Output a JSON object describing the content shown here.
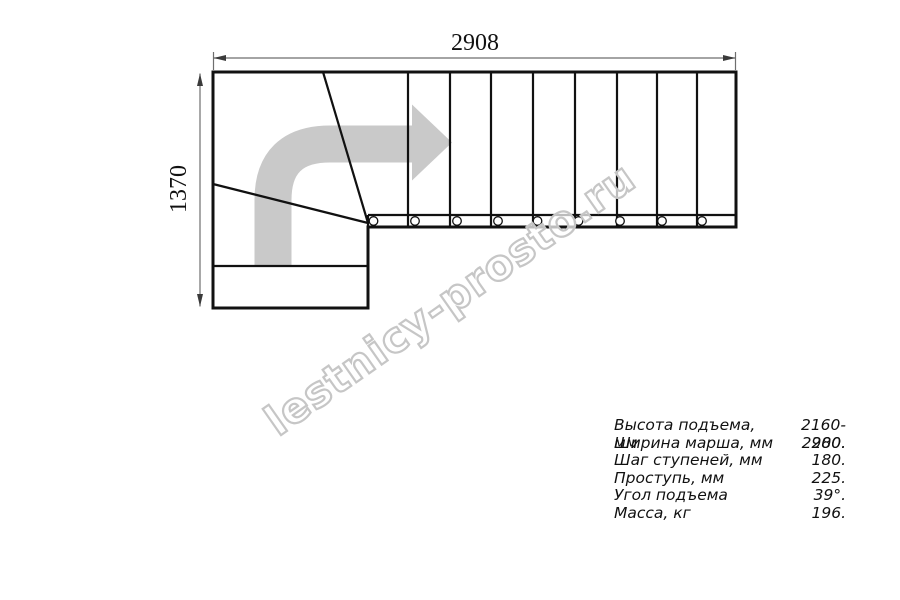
{
  "drawing": {
    "top_dimension": "2908",
    "left_dimension": "1370",
    "watermark": "lestnicy-prosto.ru",
    "direction_arrow": "turn-up-then-right",
    "straight_treads": 9,
    "tread_lines_x": [
      408,
      450,
      491,
      533,
      575,
      617,
      657,
      697
    ],
    "stringer_holes_x": [
      373.5,
      415,
      457,
      498,
      537.5,
      578.5,
      620,
      662,
      702
    ],
    "stringer_holes_y": 221
  },
  "specs": {
    "rows": [
      {
        "label": "Высота подъема, мм",
        "value": "2160-2280."
      },
      {
        "label": "Ширина марша, мм",
        "value": "900."
      },
      {
        "label": "Шаг ступеней, мм",
        "value": "180."
      },
      {
        "label": "Проступь, мм",
        "value": "225."
      },
      {
        "label": "Угол подъема",
        "value": "39°."
      },
      {
        "label": "Масса, кг",
        "value": "196."
      }
    ]
  },
  "colors": {
    "background": "#ffffff",
    "line": "#111111",
    "dimension": "#6e6e6e",
    "arrow_fill": "#c9c9c9",
    "watermark_outline": "#c6c6c6"
  }
}
